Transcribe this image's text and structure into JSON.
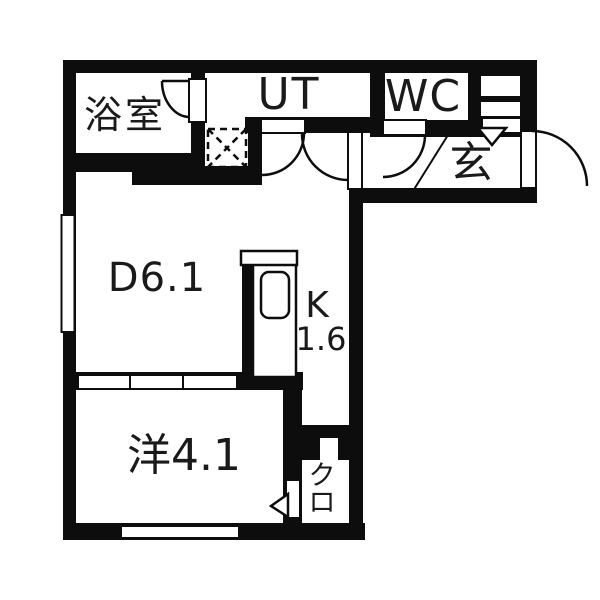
{
  "plan": {
    "background_color": "#ffffff",
    "wall_color": "#0d0d0d",
    "rooms": {
      "bathroom": {
        "label": "浴室"
      },
      "utility": {
        "label": "UT"
      },
      "toilet": {
        "label": "WC"
      },
      "entrance": {
        "label": "玄"
      },
      "dining": {
        "label": "D6.1"
      },
      "kitchen": {
        "label": "K",
        "size": "1.6"
      },
      "western_room": {
        "label": "洋4.1"
      },
      "closet": {
        "char1": "ク",
        "char2": "ロ"
      }
    }
  }
}
